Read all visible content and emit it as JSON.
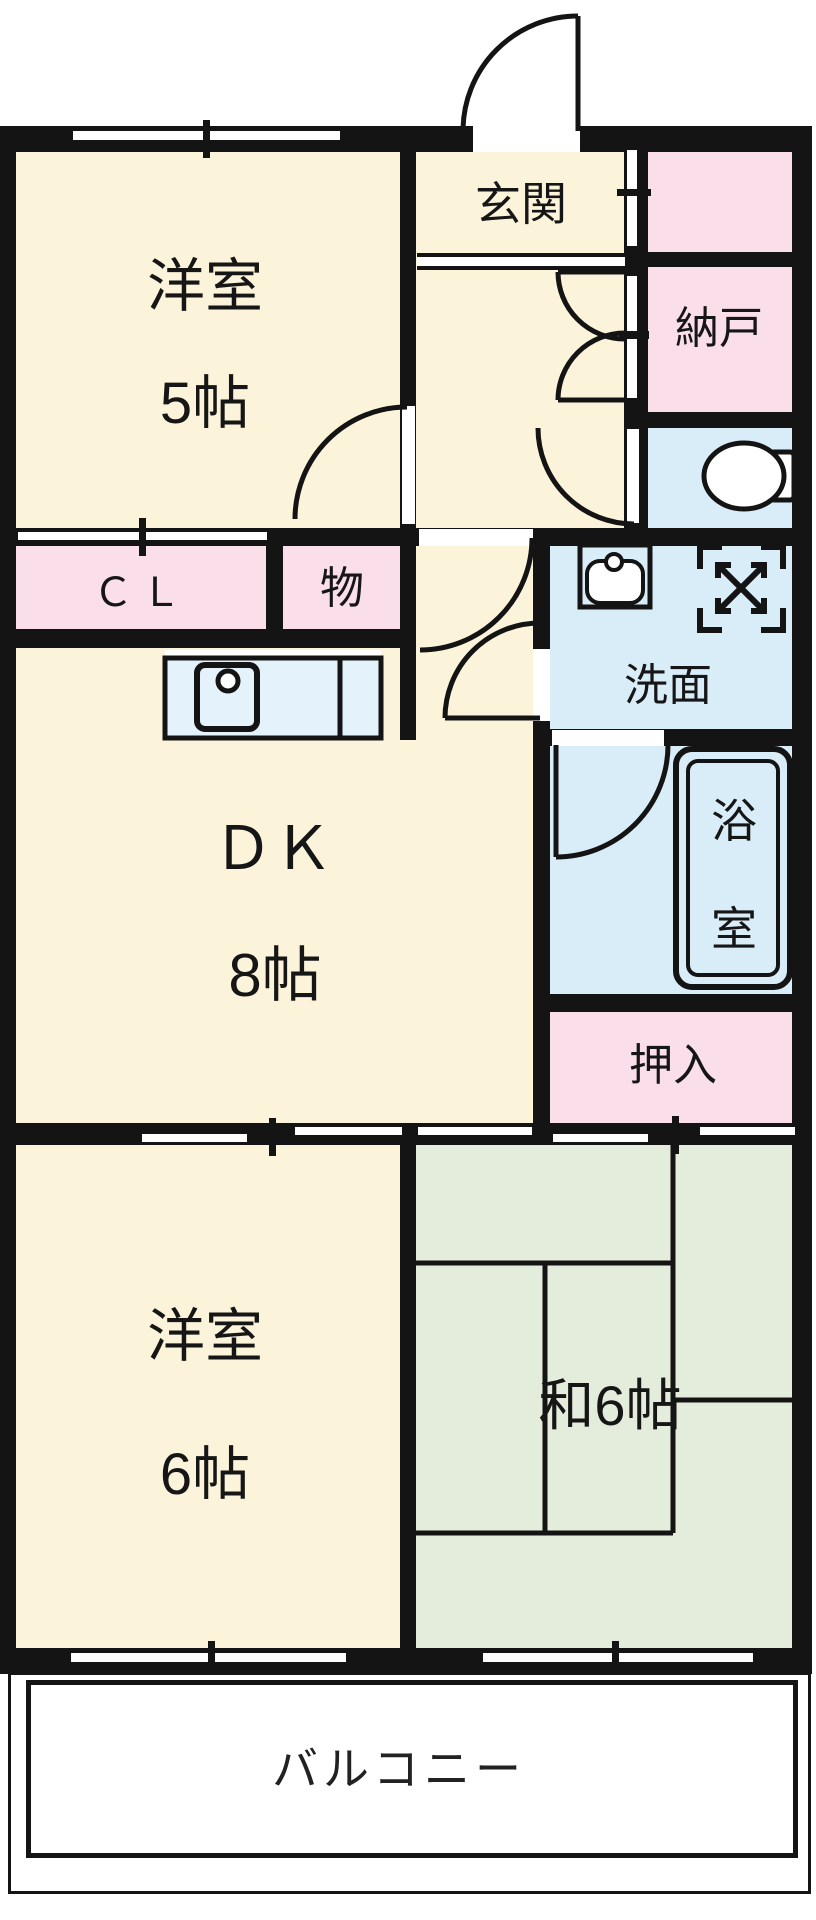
{
  "plan_title": "apartment-floorplan-2dk",
  "labels": {
    "western_room5_1": "洋室",
    "western_room5_2": "5帖",
    "entrance": "玄関",
    "storeroom": "納戸",
    "closet_cl": "ＣＬ",
    "closet_mono": "物",
    "washroom": "洗面",
    "bathroom_1": "浴",
    "bathroom_2": "室",
    "dk_1": "ＤＫ",
    "dk_2": "8帖",
    "oshiire": "押入",
    "western_room6_1": "洋室",
    "western_room6_2": "6帖",
    "japanese_room": "和6帖",
    "balcony": "バルコニー"
  },
  "rooms": [
    {
      "id": "western-room-5",
      "label": "洋室 5帖",
      "color": "#fcf4da"
    },
    {
      "id": "entrance-hall",
      "label": "玄関",
      "color": "#fcf4da"
    },
    {
      "id": "closet-top-right",
      "label": "",
      "color": "#fadeea"
    },
    {
      "id": "storeroom",
      "label": "納戸",
      "color": "#fadeea"
    },
    {
      "id": "toilet",
      "label": "",
      "color": "#d9edf9"
    },
    {
      "id": "closet-cl",
      "label": "ＣＬ",
      "color": "#fadeea"
    },
    {
      "id": "closet-mono",
      "label": "物",
      "color": "#fadeea"
    },
    {
      "id": "washroom",
      "label": "洗面",
      "color": "#d9edf9"
    },
    {
      "id": "bathroom",
      "label": "浴室",
      "color": "#d9edf9"
    },
    {
      "id": "dining-kitchen",
      "label": "ＤＫ 8帖",
      "color": "#fcf4da"
    },
    {
      "id": "oshiire-closet",
      "label": "押入",
      "color": "#fadeea"
    },
    {
      "id": "western-room-6",
      "label": "洋室 6帖",
      "color": "#fcf4da"
    },
    {
      "id": "japanese-room",
      "label": "和6帖",
      "color": "#e4eddc"
    },
    {
      "id": "balcony",
      "label": "バルコニー",
      "color": "#ffffff"
    }
  ],
  "icons": [
    "toilet-icon",
    "washbasin-icon",
    "washing-machine-icon",
    "bathtub-icon",
    "kitchen-sink-icon",
    "door-swing-icon",
    "sliding-window-icon"
  ],
  "colors": {
    "wall": "#141414",
    "room_cream": "#fcf4da",
    "closet_pink": "#fadeea",
    "wet_area_blue": "#d9edf9",
    "tatami_green": "#e4eddc",
    "counter_blue": "#e4f3fb",
    "background": "#ffffff"
  }
}
